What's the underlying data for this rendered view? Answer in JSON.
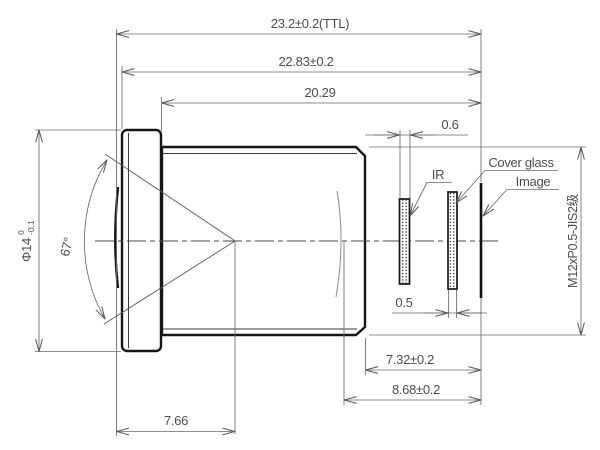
{
  "dims": {
    "ttl": "23.2±0.2(TTL)",
    "lens_length": "22.83±0.2",
    "barrel_length": "20.29",
    "flange_to_image": "7.32±0.2",
    "rear_vertex_to_image": "8.68±0.2",
    "front_length": "7.66",
    "ir_thickness": "0.6",
    "cover_thickness": "0.5"
  },
  "labels": {
    "ir": "IR",
    "cover_glass": "Cover glass",
    "image": "Image",
    "fov": "67°",
    "thread": "M12xP0.5-JIS2级",
    "diameter": "Φ14",
    "dia_tol_up": "0",
    "dia_tol_dn": "-0.1"
  },
  "colors": {
    "outline": "#161616",
    "dimension": "#6a6a6a",
    "text": "#4d4d4d",
    "background": "#ffffff"
  }
}
